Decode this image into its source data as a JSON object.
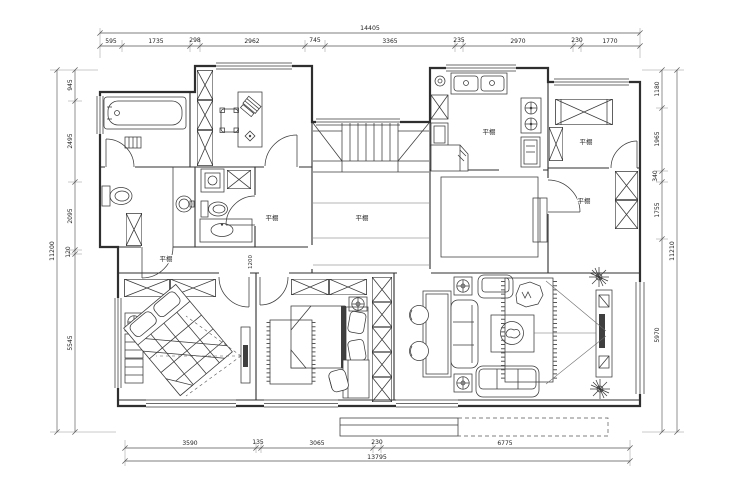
{
  "page": {
    "type": "architectural floor plan drawing",
    "background": "#ffffff",
    "line_color": "#2f2f2f"
  },
  "plan_labels": {
    "ceiling": "平棚",
    "interior_dim_1200": "1200"
  },
  "dimensions": {
    "top": {
      "total": "14405",
      "segments": [
        "595",
        "1735",
        "298",
        "2962",
        "745",
        "3365",
        "235",
        "2970",
        "230",
        "1770"
      ]
    },
    "bottom": {
      "total": "13795",
      "segments": [
        "3590",
        "135",
        "3065",
        "230",
        "6775"
      ]
    },
    "left": {
      "total": "11200",
      "segments": [
        "945",
        "2495",
        "2095",
        "120",
        "5545"
      ]
    },
    "right": {
      "total": "11210",
      "segments": [
        "1180",
        "1965",
        "340",
        "1755",
        "5970"
      ]
    }
  }
}
